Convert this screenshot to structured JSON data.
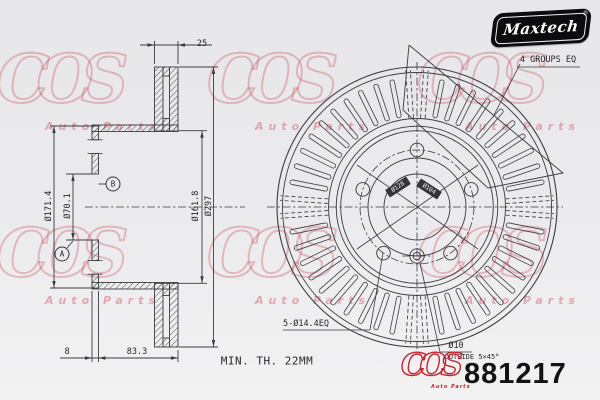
{
  "brand": {
    "name": "Maxtech",
    "reg": "®"
  },
  "watermark": {
    "script": "COS",
    "subtext": "Auto Parts"
  },
  "section_view": {
    "dim_width": "25",
    "dia_hat": "Ø171.4",
    "dia_bore": "Ø70.1",
    "dia_friction_inner": "Ø161.8",
    "dia_outer": "Ø297",
    "dim_flange": "8",
    "dim_depth": "83.3",
    "label_a": "A",
    "label_b": "B"
  },
  "front_view": {
    "note_groups": "4 GROUPS EQ",
    "note_bolts": "5-Ø14.4EQ",
    "note_pin": "Ø10",
    "note_pin_chamfer": "OUTSIDE 5×45°",
    "dia_bolt_circle": "Ø128",
    "dia_hub": "Ø104"
  },
  "notes": {
    "min_thickness": "MIN. TH. 22MM"
  },
  "footer": {
    "logo_script": "COS",
    "logo_subtext": "Auto Parts",
    "part_number": "881217"
  }
}
